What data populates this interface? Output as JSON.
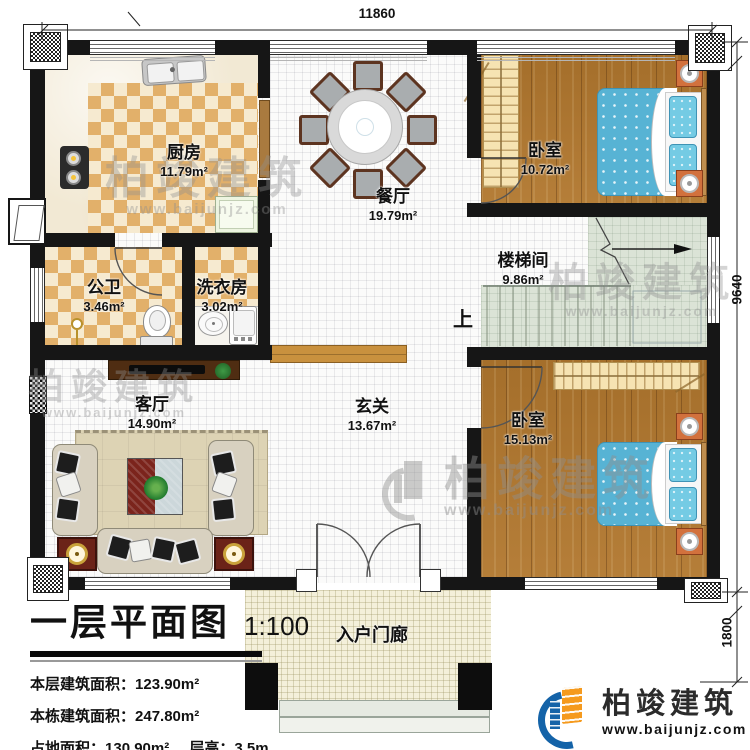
{
  "plan_info": {
    "title": "一层平面图",
    "scale": "1:100",
    "stats": [
      {
        "label": "本层建筑面积：",
        "value": "123.90m²"
      },
      {
        "label": "本栋建筑面积：",
        "value": "247.80m²"
      },
      {
        "label": "占地面积：",
        "value": "130.90m²"
      },
      {
        "label": "层高：",
        "value": "3.5m"
      }
    ]
  },
  "dimensions": {
    "top_width": "11860",
    "right_height": "9640",
    "porch_depth": "1800"
  },
  "rooms": {
    "kitchen": {
      "name": "厨房",
      "area": "11.79m²"
    },
    "dining": {
      "name": "餐厅",
      "area": "19.79m²"
    },
    "bedroom_top": {
      "name": "卧室",
      "area": "10.72m²"
    },
    "stairwell": {
      "name": "楼梯间",
      "area": "9.86m²"
    },
    "bathroom": {
      "name": "公卫",
      "area": "3.46m²"
    },
    "laundry": {
      "name": "洗衣房",
      "area": "3.02m²"
    },
    "living": {
      "name": "客厅",
      "area": "14.90m²"
    },
    "foyer": {
      "name": "玄关",
      "area": "13.67m²"
    },
    "bedroom_bottom": {
      "name": "卧室",
      "area": "15.13m²"
    },
    "porch": {
      "name": "入户门廊"
    }
  },
  "stairs": {
    "direction_label": "上"
  },
  "branding": {
    "company": "柏竣建筑",
    "website": "www.baijunjz.com"
  },
  "watermark": {
    "company": "柏竣建筑",
    "website": "www.baijunjz.com"
  },
  "colors": {
    "wall": "#161616",
    "checker": "#e2b06a",
    "wood": "#b1772e",
    "bed": "#57b3d4",
    "stair_floor": "#dbe3d6",
    "logo_blue": "#1463a8",
    "logo_orange": "#f59a1e"
  }
}
